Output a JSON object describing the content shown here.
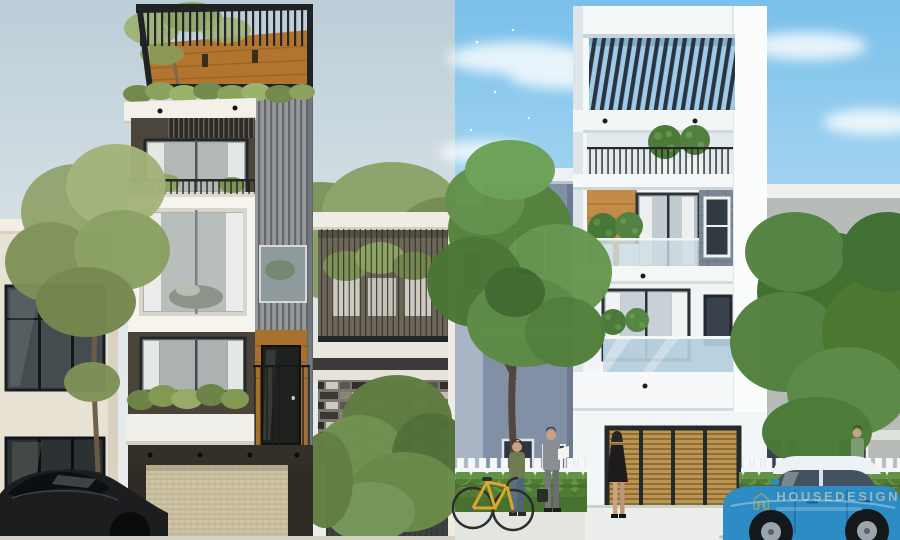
{
  "meta": {
    "description": "Two 3D exterior renders of modern narrow townhouses shown side by side",
    "width_px": 900,
    "height_px": 540
  },
  "watermark": {
    "brand_text": "HOUSEDESIGN",
    "logo": "house-outline-icon",
    "logo_color": "#d8b44a"
  },
  "left_render": {
    "label": "Street elevation render: dark grey, white and wood 4-storey townhouse",
    "sky_color": "#c2d0d9",
    "main_house": {
      "facade_colors": [
        "#f6f4ef",
        "#4b453c",
        "#b1752f",
        "#95999c"
      ],
      "floors": 4,
      "features": [
        "rooftop steel pergola with tree",
        "planted balcony strips",
        "vertical slat cladding column",
        "beige roller garage door",
        "dark wood entry door"
      ]
    },
    "left_neighbor": {
      "color": "#e8e2d5",
      "features": [
        "glass storefront windows"
      ]
    },
    "right_neighbor": {
      "color": "#76726a",
      "features": [
        "cable-rail balcony with planters",
        "stone mosaic wall",
        "dark garage gate"
      ]
    },
    "parked_car": {
      "type": "dark sedan",
      "color": "#1b1d1f"
    },
    "tree_color": "#8aa062"
  },
  "right_render": {
    "label": "Street elevation render: white 4-storey townhouse under blue sky",
    "sky_color": "#7cc1ea",
    "main_house": {
      "facade_colors": [
        "#f4f7f8",
        "#c28c48",
        "#7c8694",
        "#2b3340"
      ],
      "floors": 4,
      "features": [
        "louvered roof pergola",
        "round topiary planters",
        "glass balustrades",
        "grey stone tile column",
        "wood-slat garage door"
      ]
    },
    "left_neighbor": {
      "color": "#8290a6"
    },
    "right_neighbor": {
      "color": "#b7bcb8"
    },
    "street": {
      "fence": "white picket fence",
      "hedge_color": "#48702f",
      "pedestrian_count": 5,
      "bicycle_color": "#d9a82a",
      "car": {
        "type": "mini hatchback",
        "body_color": "#2d8cc3",
        "roof_color": "#edf2f4"
      }
    }
  }
}
